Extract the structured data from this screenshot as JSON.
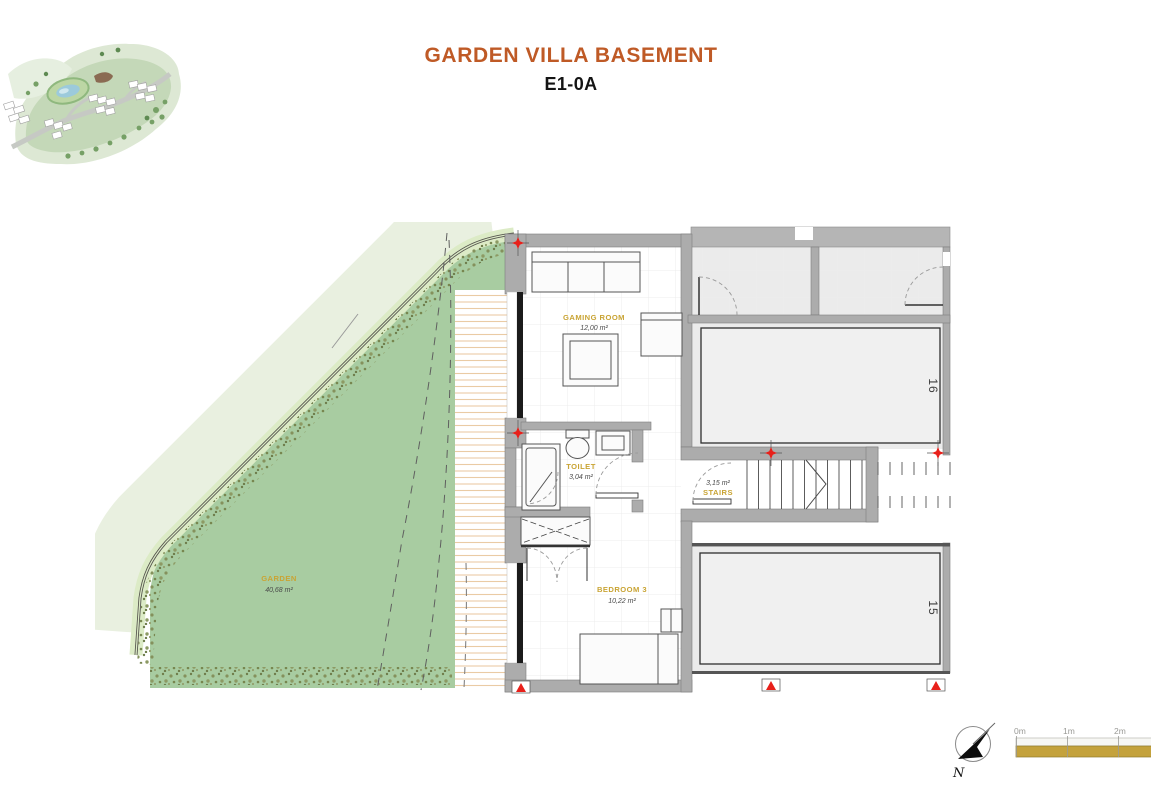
{
  "header": {
    "title": "GARDEN VILLA BASEMENT",
    "subtitle": "E1-0A"
  },
  "plan": {
    "rooms": [
      {
        "name": "GAMING ROOM",
        "area": "12,00 m²"
      },
      {
        "name": "TOILET",
        "area": "3,04 m²"
      },
      {
        "name": "STAIRS",
        "area": "3,15 m²"
      },
      {
        "name": "BEDROOM 3",
        "area": "10,22 m²"
      },
      {
        "name": "GARDEN",
        "area": "40,68 m²"
      }
    ],
    "parking_spaces": [
      "16",
      "15"
    ]
  },
  "compass": {
    "label": "N"
  },
  "scale_bar": {
    "ticks": [
      "0m",
      "1m",
      "2m"
    ]
  },
  "colors": {
    "title_accent": "#bf5a26",
    "room_label_gold": "#c9a434",
    "garden_green": "#a8cca1",
    "scale_gold": "#c4a23c",
    "marker_red": "#e8201a",
    "wall_gray": "#acacac"
  }
}
